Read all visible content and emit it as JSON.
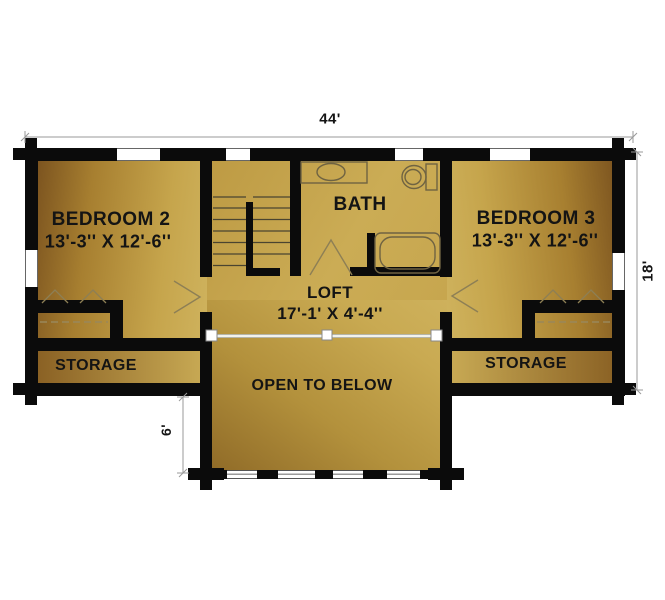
{
  "plan": {
    "title": "Log home second floor plan",
    "rooms": {
      "bedroom2": {
        "name": "BEDROOM 2",
        "dims": "13'-3'' X 12'-6''"
      },
      "bath": {
        "name": "BATH"
      },
      "bedroom3": {
        "name": "BEDROOM 3",
        "dims": "13'-3'' X 12'-6''"
      },
      "loft": {
        "name": "LOFT",
        "dims": "17'-1' X 4'-4''"
      },
      "storage_left": {
        "name": "STORAGE"
      },
      "storage_right": {
        "name": "STORAGE"
      },
      "open_to_below": {
        "name": "OPEN TO BELOW"
      }
    },
    "dimensions": {
      "overall_width": "44'",
      "overall_depth": "18'",
      "open_below_depth": "6'"
    },
    "colors": {
      "wall": "#0b0b0b",
      "floor_dark": "#7b531f",
      "floor_light": "#cfb35e",
      "text": "#141414"
    }
  }
}
